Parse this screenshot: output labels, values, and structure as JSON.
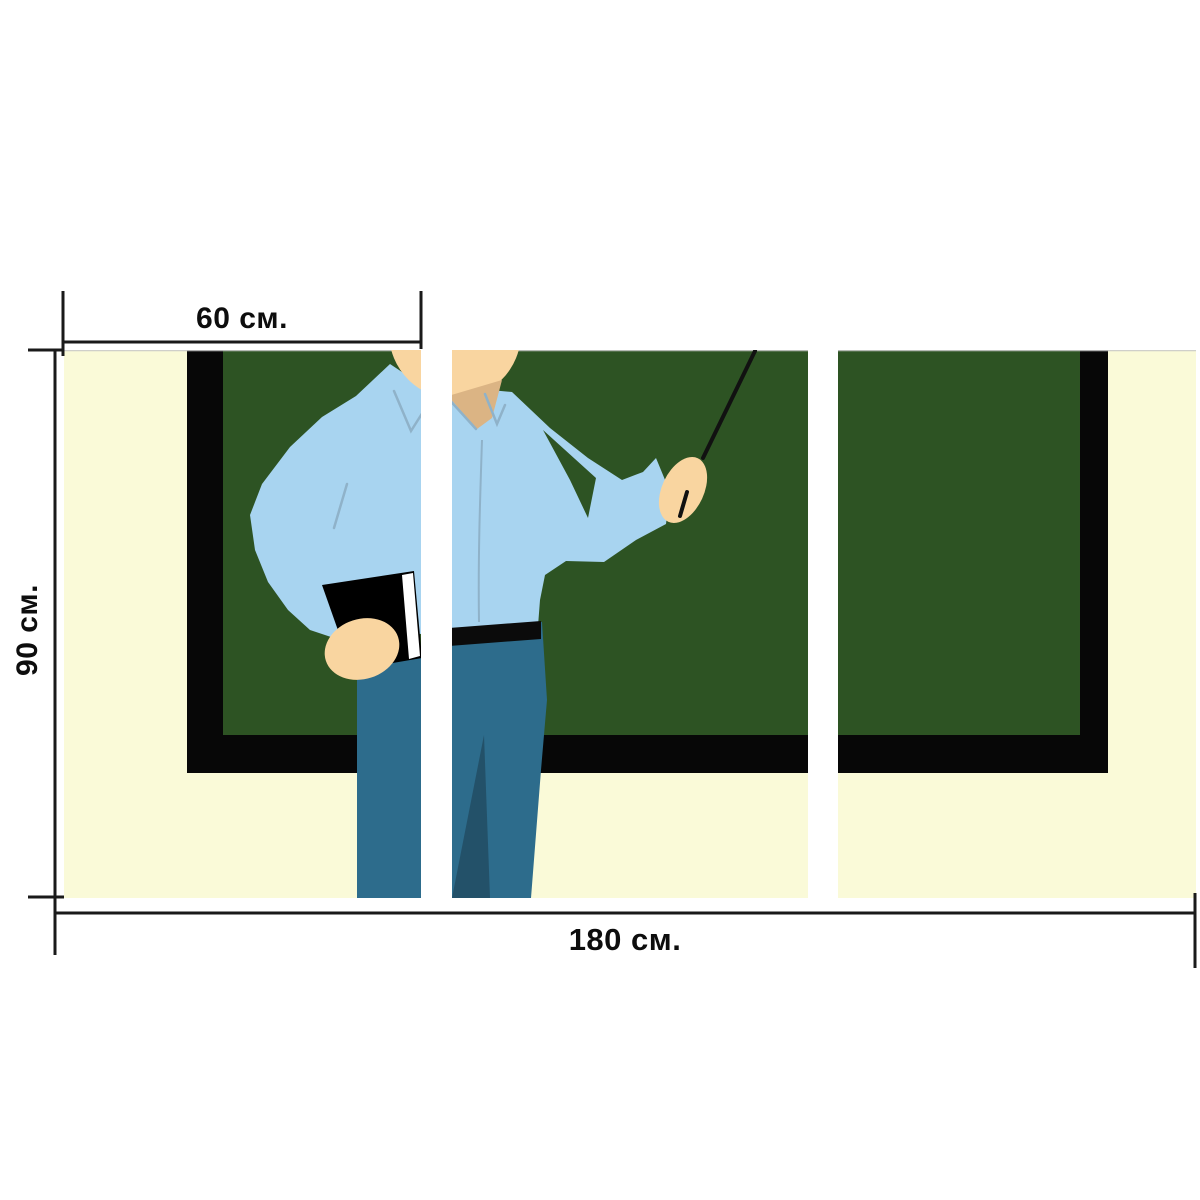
{
  "meta": {
    "type": "triptych-canvas-print-mockup",
    "panel_count": 3
  },
  "dimensions": {
    "panel_width_label": "60 см.",
    "height_label": "90 см.",
    "total_width_label": "180 см."
  },
  "colors": {
    "background": "#ffffff",
    "wall": "#fafad8",
    "board_green": "#2d5323",
    "frame_black": "#070707",
    "shirt_blue": "#a8d4f0",
    "shirt_fold": "#8fb2c9",
    "skin": "#f9d5a0",
    "skin_shadow": "#dbb484",
    "pants": "#2d6c8c",
    "pants_shadow": "#235169",
    "belt": "#0b0b0b",
    "book_cover": "#000000",
    "book_pages": "#ffffff",
    "pointer": "#111111",
    "dimension_line": "#1a1a1a",
    "label_text": "#0d0d0d",
    "panel_edge": "#c9c9c9"
  }
}
